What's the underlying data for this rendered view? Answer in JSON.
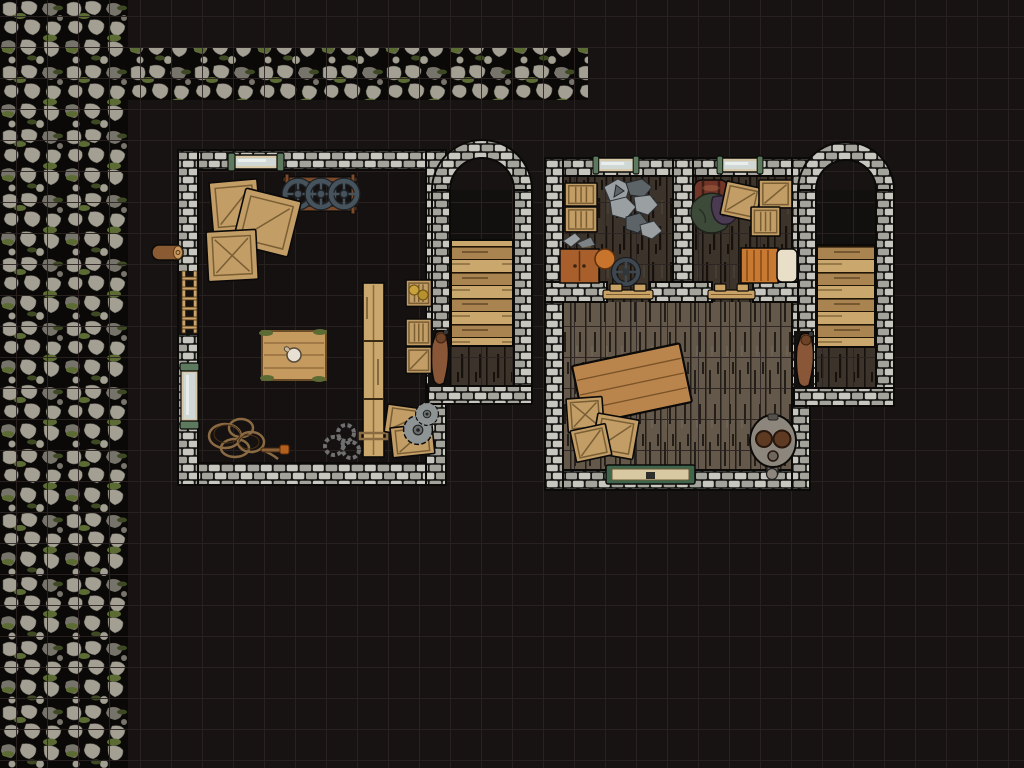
{
  "scene": {
    "name": "stone-tavern-battle-map",
    "grid_size_px": 31,
    "grid_offset_px": 16,
    "style": "top-down dungeon battle map"
  },
  "colors": {
    "bg": "#161312",
    "grid_line": "#2a2322",
    "room_floor": "#151110",
    "tower_dark": "#12100e",
    "cobble": "#a39f93",
    "cobble_dark": "#76736a",
    "cobble_gap": "#0a0908",
    "moss": "#5c6b33",
    "moss_dark": "#3f4a24",
    "wall_light": "#c7c7bf",
    "wall_mid": "#a3a39b",
    "wall_gap": "#141412",
    "outline": "#0b0a09",
    "floor_dark": "#3c332a",
    "floor_dark_streak": "#16110d",
    "floor_main": "#635849",
    "floor_main_streak": "#241e18",
    "stair_light": "#c9a76d",
    "stair_mid": "#a98350",
    "wood_crate": "#c29d66",
    "wood_crate_dark": "#7a5e34",
    "table_wood": "#b9854d",
    "rug_wood": "#c59a5e",
    "barrel": "#733527",
    "barrel_band": "#3a1d14",
    "bed": "#c87a33",
    "pillow": "#e9dfc8",
    "rope": "#8a6a42",
    "chain": "#6f6f6f",
    "wheel_metal": "#46525c",
    "rack_wood": "#7b4a2a",
    "glass": "#cfd8d4",
    "window_wood": "#d8c9a8",
    "metal_green": "#5d7a5e",
    "door_green": "#40654d",
    "door_wood": "#d9c9a2",
    "cloak": "#8a5638",
    "furnace_body": "#8d867c",
    "furnace_hole": "#5e3a22",
    "rock": "#9aa0a2",
    "rock_dark": "#5d6468",
    "clothes_green": "#3d4a3a",
    "clothes_purple": "#4a3a52",
    "log": "#8a5a32",
    "saw": "#8e9494",
    "cabinet": "#a85f2c",
    "valve": "#3e4750"
  },
  "regions": {
    "cobblestone_path": "Mossy cobblestone path",
    "storage_room": "Storage room (left)",
    "stair_tower_left": "Stair tower (center)",
    "stair_tower_right": "Stair tower (right)",
    "store_room_a": "Store room A (top-left of right building)",
    "store_room_b": "Store room B (top-right of right building)",
    "main_hall": "Main hall (right building)"
  },
  "props": {
    "window": "Window",
    "wheel_rack": "Wheel rack with three wheels",
    "crates": "Wooden crates",
    "log": "Log",
    "ladder": "Wall ladder",
    "work_rug": "Wooden mat with jug",
    "plank_walk": "Long plank walkway",
    "supply_crates": "Small supply crates",
    "rope_pile": "Coiled rope",
    "torch": "Torch",
    "chains": "Chain coils",
    "saw_crates": "Crates with saw blades",
    "rock_pile": "Pile of stones",
    "tool": "Smith tools",
    "cabinet": "Cabinet",
    "ball": "Clay pot",
    "valve_wheel": "Valve wheel",
    "barrel": "Barrel",
    "clothes": "Piled garments",
    "bed": "Bedroll with pillow",
    "big_table": "Long wooden table",
    "furnace": "Double furnace",
    "green_door": "Reinforced green door",
    "door_sill": "Doorway threshold",
    "stairs": "Wooden stairs",
    "cloak": "Hanging cloak"
  }
}
